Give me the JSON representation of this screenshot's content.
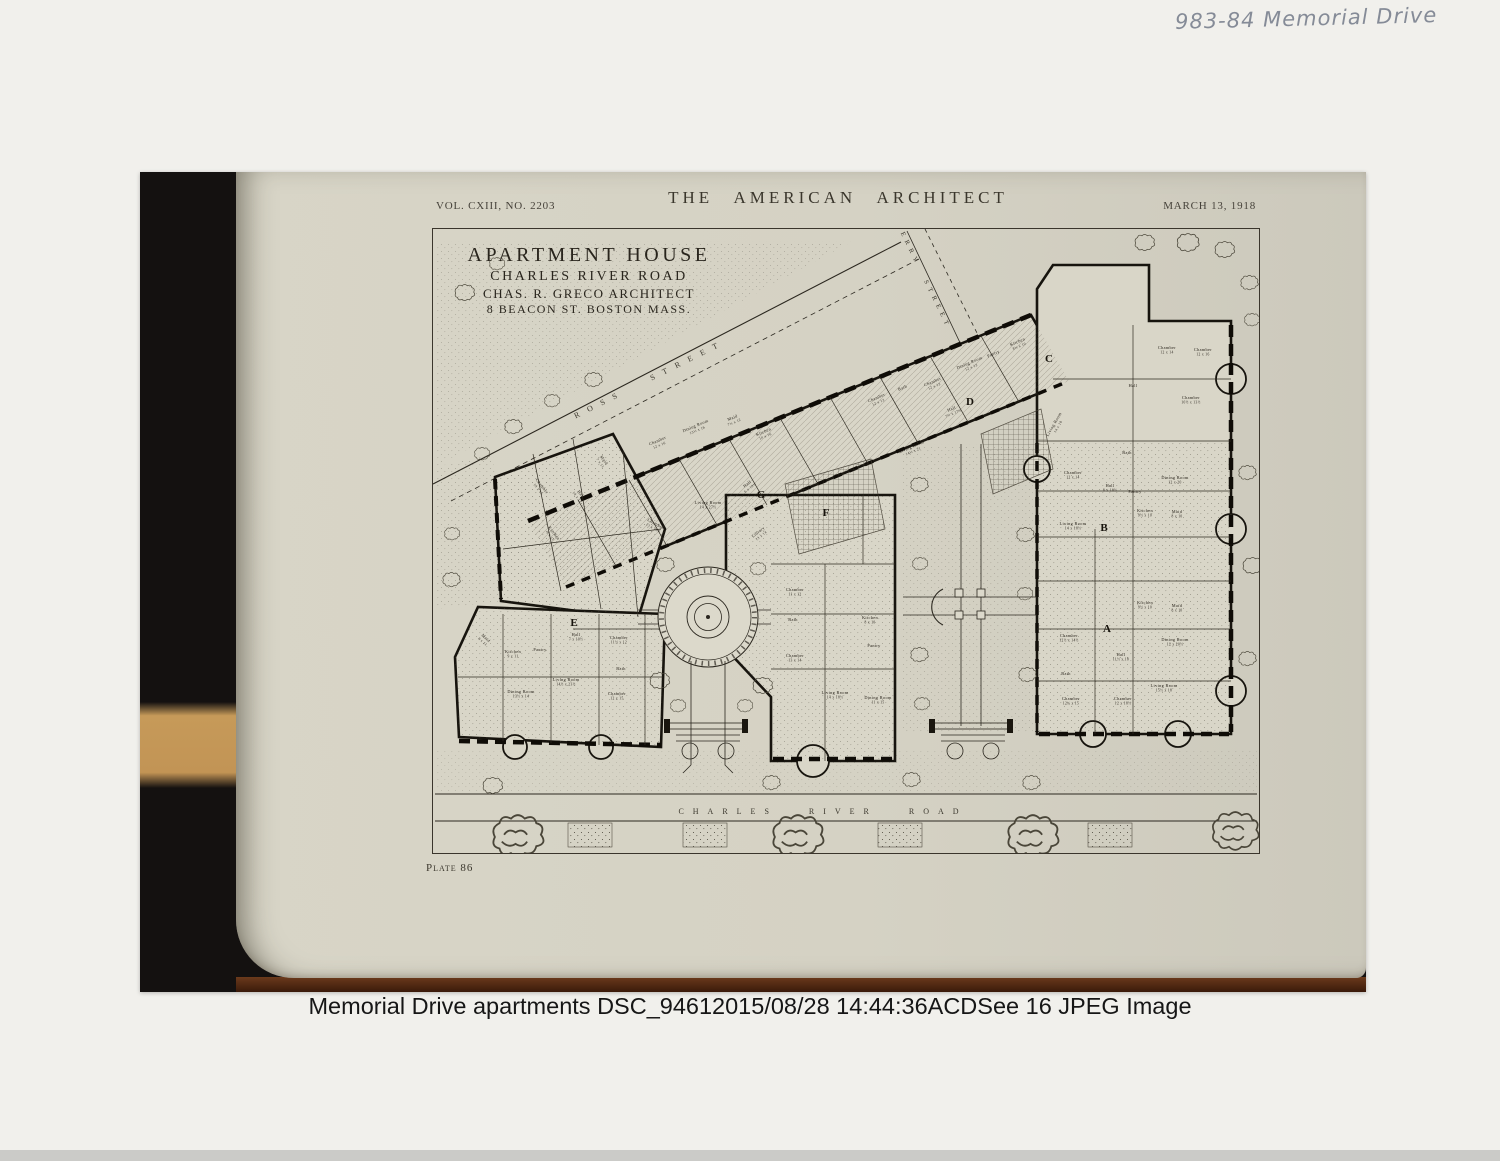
{
  "annotation": {
    "text": "983-84 Memorial Drive"
  },
  "caption": {
    "text": "Memorial Drive apartments DSC_94612015/08/28 14:44:36ACDSee 16 JPEG Image"
  },
  "page": {
    "header": {
      "volume": "VOL. CXIII, NO. 2203",
      "title": "THE AMERICAN ARCHITECT",
      "date": "MARCH 13, 1918"
    },
    "title_block": {
      "line1": "APARTMENT HOUSE",
      "line2": "CHARLES RIVER ROAD",
      "line3": "CHAS. R. GRECO ARCHITECT",
      "line4": "8 BEACON ST. BOSTON MASS."
    },
    "plate_label": "Plate 86",
    "plan": {
      "streets": {
        "top": "ROSS STREET",
        "right": "GERRY STREET",
        "bottom": "CHARLES RIVER ROAD"
      },
      "entry_letters": [
        {
          "t": "A",
          "x": 674,
          "y": 403
        },
        {
          "t": "B",
          "x": 671,
          "y": 302
        },
        {
          "t": "C",
          "x": 616,
          "y": 133
        },
        {
          "t": "D",
          "x": 537,
          "y": 176
        },
        {
          "t": "E",
          "x": 141,
          "y": 397
        },
        {
          "t": "F",
          "x": 393,
          "y": 287
        },
        {
          "t": "G",
          "x": 328,
          "y": 269
        }
      ],
      "room_labels": [
        {
          "t": "Chamber",
          "d": "12 x 16",
          "x": 225,
          "y": 213,
          "r": -23
        },
        {
          "t": "Dining Room",
          "d": "13½ x 16",
          "x": 263,
          "y": 198,
          "r": -23
        },
        {
          "t": "Maid",
          "d": "7½ x 12",
          "x": 300,
          "y": 190,
          "r": -23
        },
        {
          "t": "Kitchen",
          "d": "10 x 16",
          "x": 331,
          "y": 204,
          "r": -23
        },
        {
          "t": "Chamber",
          "d": "12 x 13",
          "x": 444,
          "y": 170,
          "r": -23
        },
        {
          "t": "Bath",
          "d": "",
          "x": 470,
          "y": 160,
          "r": -23
        },
        {
          "t": "Chamber",
          "d": "12 x 13",
          "x": 500,
          "y": 154,
          "r": -23
        },
        {
          "t": "Dining Room",
          "d": "12 x 13",
          "x": 537,
          "y": 135,
          "r": -23
        },
        {
          "t": "Pantry",
          "d": "",
          "x": 561,
          "y": 126,
          "r": -23
        },
        {
          "t": "Kitchen",
          "d": "8½ x 10",
          "x": 585,
          "y": 114,
          "r": -23
        },
        {
          "t": "Hall",
          "d": "7½ x 17½",
          "x": 519,
          "y": 181,
          "r": -23
        },
        {
          "t": "Living Room",
          "d": "14½ x 21",
          "x": 479,
          "y": 219,
          "r": -23
        },
        {
          "t": "Chamber",
          "d": "13 x 16",
          "x": 108,
          "y": 258,
          "r": 52
        },
        {
          "t": "Hall",
          "d": "10 x 12",
          "x": 147,
          "y": 266,
          "r": 52
        },
        {
          "t": "Maid",
          "d": "7 x 11",
          "x": 170,
          "y": 232,
          "r": 52
        },
        {
          "t": "Kitchen",
          "d": "9 x 11",
          "x": 120,
          "y": 305,
          "r": 52
        },
        {
          "t": "Living Room",
          "d": "14 x 27½",
          "x": 275,
          "y": 275,
          "r": 0
        },
        {
          "t": "Hall",
          "d": "6 x 19½",
          "x": 315,
          "y": 256,
          "r": -38
        },
        {
          "t": "Library",
          "d": "13 x 14",
          "x": 326,
          "y": 304,
          "r": -38
        },
        {
          "t": "Chamber",
          "d": "13 x 18¾",
          "x": 222,
          "y": 296,
          "r": 30
        },
        {
          "t": "Maid",
          "d": "8 x 11",
          "x": 52,
          "y": 410,
          "r": 42
        },
        {
          "t": "Kitchen",
          "d": "9 x 11",
          "x": 80,
          "y": 424,
          "r": 0
        },
        {
          "t": "Pantry",
          "d": "",
          "x": 107,
          "y": 422,
          "r": 0
        },
        {
          "t": "Dining Room",
          "d": "13½ x 14",
          "x": 88,
          "y": 464,
          "r": 0
        },
        {
          "t": "Living Room",
          "d": "14½ x 23½",
          "x": 133,
          "y": 452,
          "r": 0
        },
        {
          "t": "Hall",
          "d": "7 x 10½",
          "x": 143,
          "y": 407,
          "r": 0
        },
        {
          "t": "Chamber",
          "d": "11½ x 12",
          "x": 186,
          "y": 410,
          "r": 0
        },
        {
          "t": "Bath",
          "d": "",
          "x": 188,
          "y": 441,
          "r": 0
        },
        {
          "t": "Chamber",
          "d": "12 x 15",
          "x": 184,
          "y": 466,
          "r": 0
        },
        {
          "t": "Chamber",
          "d": "11 x 12",
          "x": 362,
          "y": 362,
          "r": 0
        },
        {
          "t": "Bath",
          "d": "",
          "x": 360,
          "y": 392,
          "r": 0
        },
        {
          "t": "Chamber",
          "d": "13 x 14",
          "x": 362,
          "y": 428,
          "r": 0
        },
        {
          "t": "Living Room",
          "d": "14 x 18½",
          "x": 402,
          "y": 465,
          "r": 0
        },
        {
          "t": "Dining Room",
          "d": "11 x 15",
          "x": 445,
          "y": 470,
          "r": 0
        },
        {
          "t": "Kitchen",
          "d": "8 x 10",
          "x": 437,
          "y": 390,
          "r": 0
        },
        {
          "t": "Pantry",
          "d": "",
          "x": 441,
          "y": 418,
          "r": 0
        },
        {
          "t": "Chamber",
          "d": "12 x 14",
          "x": 640,
          "y": 245,
          "r": 0
        },
        {
          "t": "Bath",
          "d": "",
          "x": 694,
          "y": 225,
          "r": 0
        },
        {
          "t": "Hall",
          "d": "8 x 16½",
          "x": 677,
          "y": 258,
          "r": 0
        },
        {
          "t": "Dining Room",
          "d": "12 x 20",
          "x": 742,
          "y": 250,
          "r": 0
        },
        {
          "t": "Pantry",
          "d": "",
          "x": 702,
          "y": 264,
          "r": 0
        },
        {
          "t": "Kitchen",
          "d": "9½ x 10",
          "x": 712,
          "y": 283,
          "r": 0
        },
        {
          "t": "Maid",
          "d": "8 x 10",
          "x": 744,
          "y": 284,
          "r": 0
        },
        {
          "t": "Living Room",
          "d": "14 x 18½",
          "x": 640,
          "y": 296,
          "r": 0
        },
        {
          "t": "Chamber",
          "d": "12 x 14",
          "x": 734,
          "y": 120,
          "r": 0
        },
        {
          "t": "Chamber",
          "d": "12 x 16",
          "x": 770,
          "y": 122,
          "r": 0
        },
        {
          "t": "Chamber",
          "d": "10½ x 13½",
          "x": 758,
          "y": 170,
          "r": 0
        },
        {
          "t": "Hall",
          "d": "",
          "x": 700,
          "y": 158,
          "r": 0
        },
        {
          "t": "Living Room",
          "d": "14 x 18",
          "x": 622,
          "y": 196,
          "r": -60
        },
        {
          "t": "Chamber",
          "d": "12½ x 14½",
          "x": 636,
          "y": 408,
          "r": 0
        },
        {
          "t": "Hall",
          "d": "11½ x 18",
          "x": 688,
          "y": 427,
          "r": 0
        },
        {
          "t": "Dining Room",
          "d": "12 x 20½",
          "x": 742,
          "y": 412,
          "r": 0
        },
        {
          "t": "Bath",
          "d": "",
          "x": 633,
          "y": 446,
          "r": 0
        },
        {
          "t": "Chamber",
          "d": "12¾ x 15",
          "x": 638,
          "y": 471,
          "r": 0
        },
        {
          "t": "Chamber",
          "d": "12 x 18½",
          "x": 690,
          "y": 471,
          "r": 0
        },
        {
          "t": "Living Room",
          "d": "15½ x 18",
          "x": 731,
          "y": 458,
          "r": 0
        },
        {
          "t": "Kitchen",
          "d": "9½ x 10",
          "x": 712,
          "y": 375,
          "r": 0
        },
        {
          "t": "Maid",
          "d": "8 x 10",
          "x": 744,
          "y": 378,
          "r": 0
        }
      ]
    }
  },
  "colors": {
    "page_paper": "#d6d3c5",
    "ink": "#2c2820",
    "gutter_black": "#141110",
    "wood_tan": "#c69a59",
    "table_edge_brown": "#4a2413",
    "caption_text": "#161616",
    "handwriting": "#858b97"
  }
}
